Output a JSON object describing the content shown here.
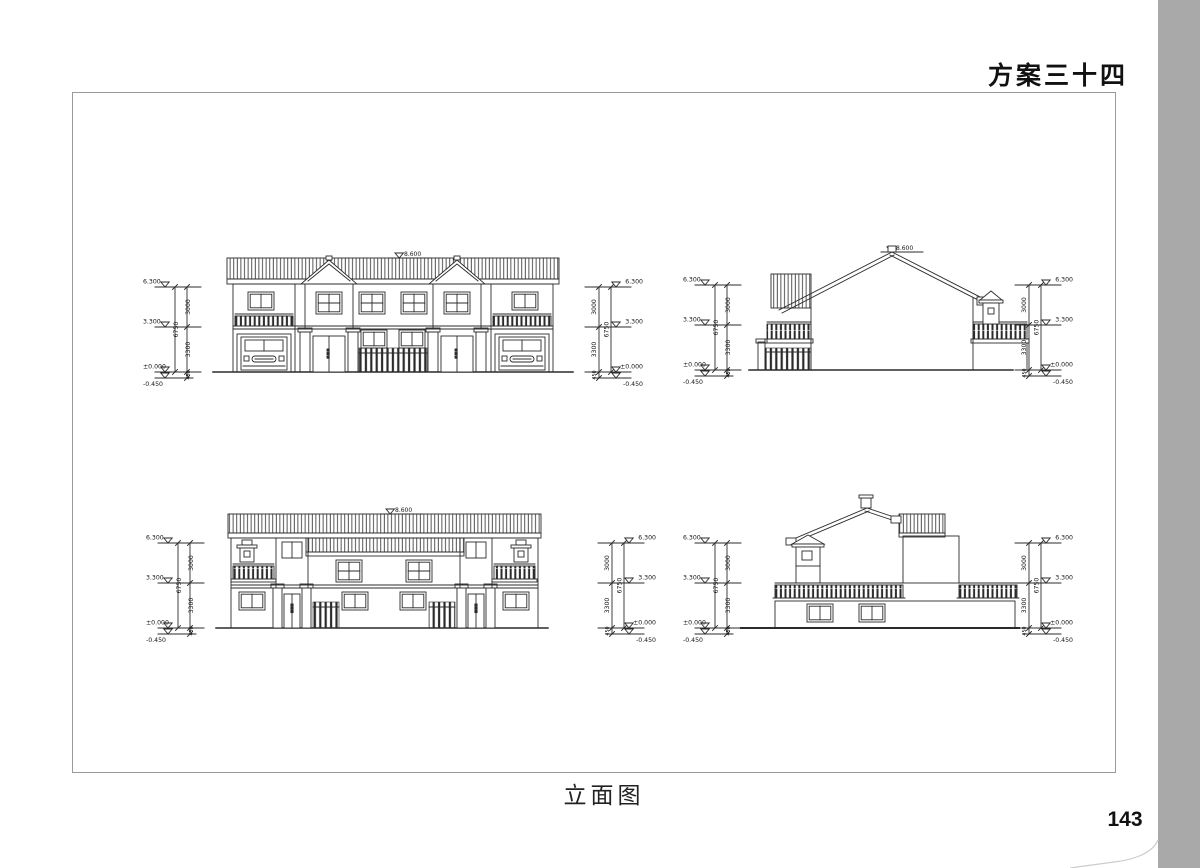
{
  "page": {
    "title": "方案三十四",
    "caption": "立面图",
    "page_number": "143"
  },
  "levels": {
    "peak": "8.600",
    "eave": "6.300",
    "second_floor": "3.300",
    "ground": "±0.000",
    "foundation": "-0.450"
  },
  "dimensions": {
    "upper_storey": "3000",
    "lower_storey": "3300",
    "total_height": "6750",
    "plinth": "450"
  }
}
